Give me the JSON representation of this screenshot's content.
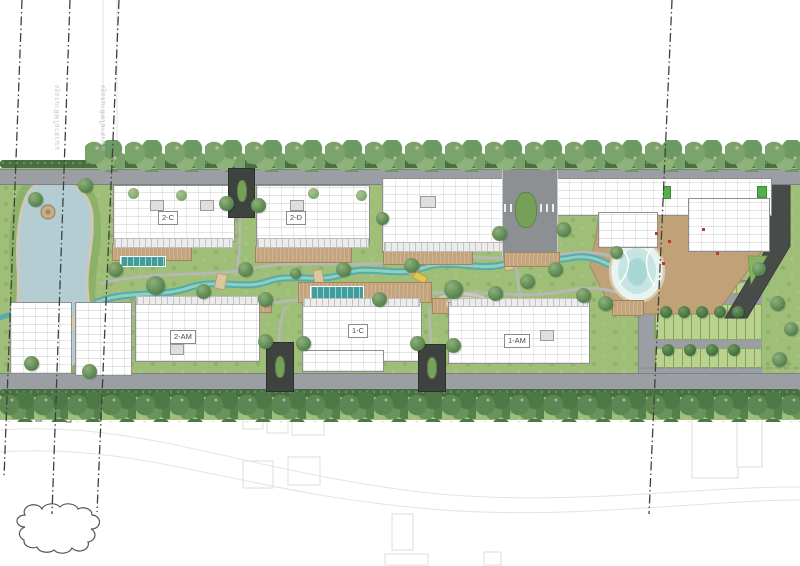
{
  "plan": {
    "type": "landscape-masterplan",
    "building_labels": {
      "b2c": "2-C",
      "b2d": "2-D",
      "b2am": "2-AM",
      "b1c": "1-C",
      "b1am": "1-AM"
    },
    "easement_labels": {
      "west_a": "แนวสายไฟฟ้าแรงสูง",
      "west_b": "แนวสายไฟฟ้าแรงสูง"
    },
    "colors": {
      "lawn": "#9fbe78",
      "pond": "#b4cdd2",
      "stream": "#57aca8",
      "lagoon_pool": "#a8d6d2",
      "wood_deck": "#c3a47d",
      "public_road": "#9b9ea2",
      "entry_drive": "#3e433f",
      "building": "#ffffff",
      "tree_canopy": "#6d9a62",
      "tree_canopy_dark": "#4d7847",
      "parking_stall": "#b9d28e",
      "lap_pool": "#3f9e9b",
      "easement_line": "#3f3f3f"
    }
  }
}
